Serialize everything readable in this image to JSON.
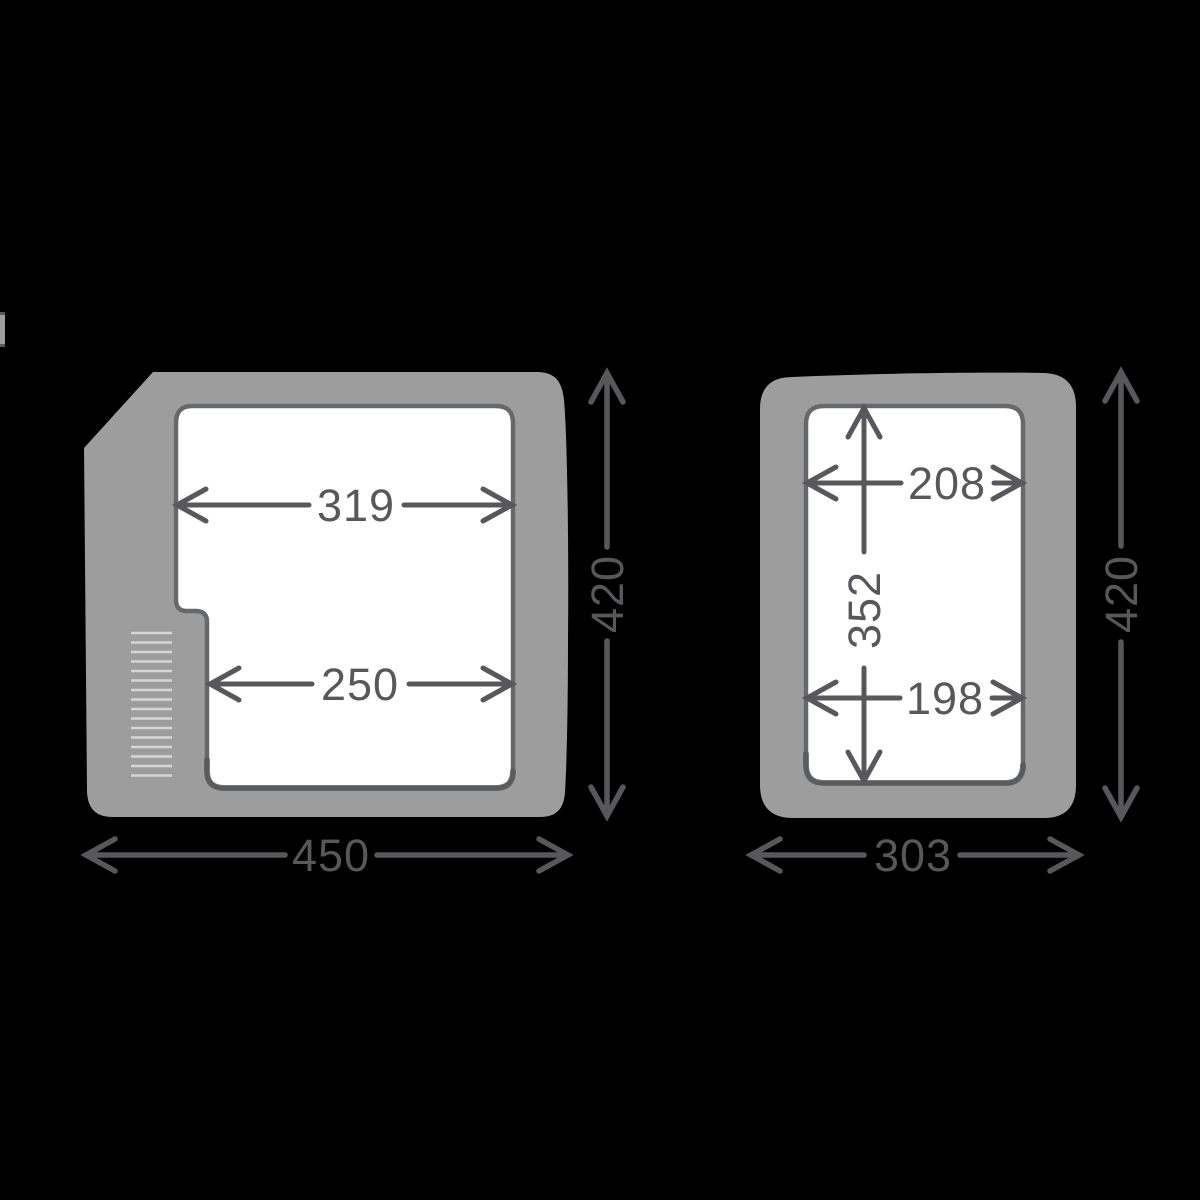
{
  "colors": {
    "background": "#000000",
    "body": "#9d9d9e",
    "cavity": "#ffffff",
    "outline": "#67686a",
    "outline_shadow": "#565759",
    "dimension": "#58585a",
    "vent": "#d6d6d7"
  },
  "figures": [
    {
      "name": "side-view",
      "dims": {
        "top_width": "319",
        "bottom_width": "250",
        "height": "420",
        "width": "450"
      }
    },
    {
      "name": "front-view",
      "dims": {
        "top_width": "208",
        "inner_height": "352",
        "bottom_width": "198",
        "height": "420",
        "width": "303"
      }
    }
  ]
}
